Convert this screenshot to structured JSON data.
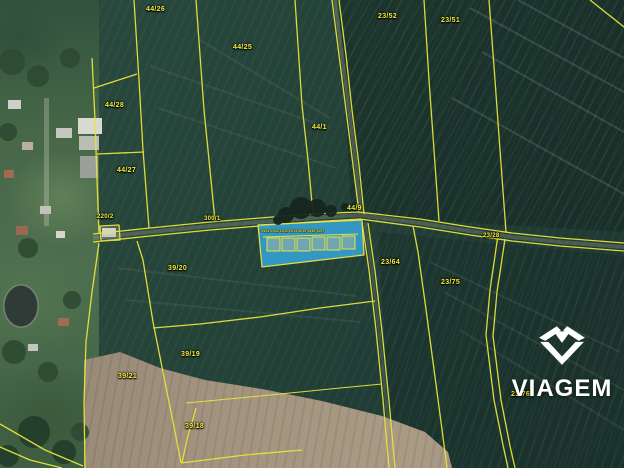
{
  "map": {
    "type": "cadastral-satellite-map",
    "watermark": {
      "brand": "VIAGEM"
    },
    "colors": {
      "parcel_line": "#e8e43a",
      "parcel_label_text": "#f2ee3e",
      "highlight_fill": "#35a7dc",
      "field_dark_green": "#24423a",
      "plowed_soil_tan": "#a2937e",
      "watermark_white": "#ffffff"
    },
    "parcel_labels": [
      "44/26",
      "44/25",
      "23/52",
      "23/51",
      "44/28",
      "44/27",
      "44/1",
      "44/9",
      "300/1",
      "220/2",
      "23/28",
      "23/64",
      "23/75",
      "23/76",
      "39/20",
      "39/19",
      "39/21",
      "39/18"
    ],
    "highlighted_parcel": {
      "garage_count": 6,
      "garage_row_labels": "44/41 44/42 44/43 44/44 44/45 44/46 44/47"
    }
  }
}
